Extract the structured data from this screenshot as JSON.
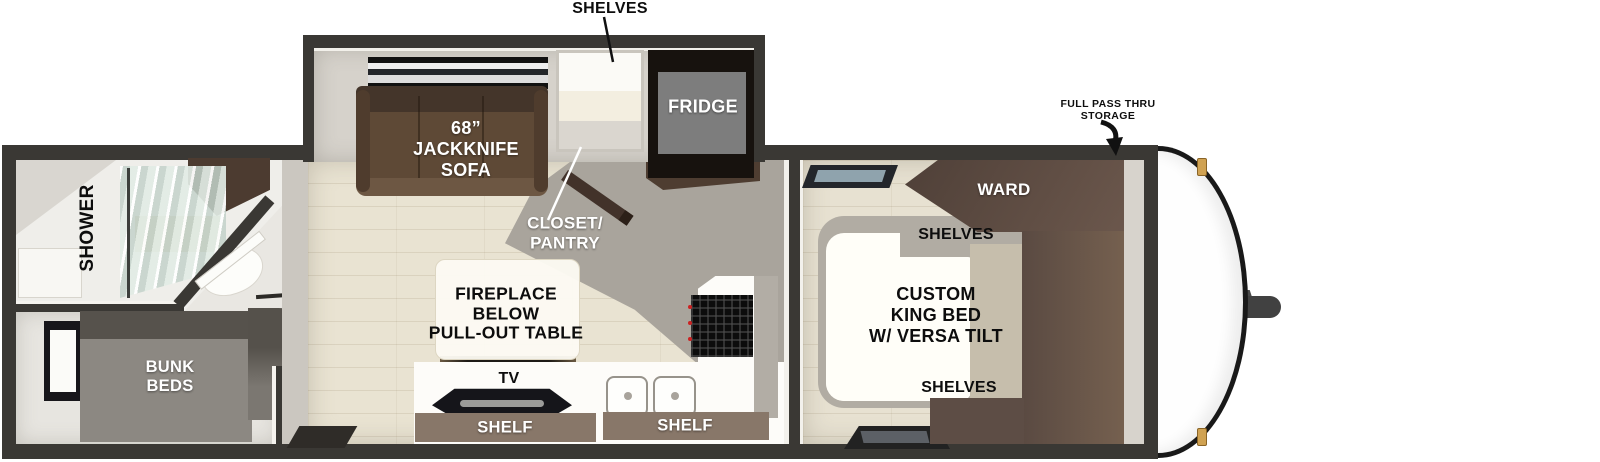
{
  "title": "Travel trailer floor plan",
  "colors": {
    "wall": "#3a3834",
    "floor": "#e9e3d2",
    "bedfloor": "#e7e1d1",
    "sofa": "#5e4936",
    "sofa_dark": "#44352a",
    "wardrobe": "#5a4a42",
    "cabinet": "#4c3b30",
    "shelfbar": "#887769",
    "counter": "#fdfcf9",
    "glass": "#cbd6d0",
    "gold": "#d0a252",
    "grayzone": "#a9a49c",
    "bunk": "#8c8882",
    "hitch": "#414141"
  },
  "labels": {
    "shelves_callout": "SHELVES",
    "sofa": "68”\nJACKKNIFE\nSOFA",
    "fridge": "FRIDGE",
    "closet_pantry": "CLOSET/\nPANTRY",
    "shower": "SHOWER",
    "bunk_beds": "BUNK\nBEDS",
    "fireplace_table": "FIREPLACE\nBELOW\nPULL-OUT TABLE",
    "tv": "TV",
    "shelf_left": "SHELF",
    "shelf_right": "SHELF",
    "king_bed": "CUSTOM\nKING BED\nW/ VERSA TILT",
    "ward": "WARD",
    "shelves_bedroom_top": "SHELVES",
    "shelves_bedroom_bottom": "SHELVES",
    "pass_thru_storage": "FULL PASS THRU\nSTORAGE"
  }
}
